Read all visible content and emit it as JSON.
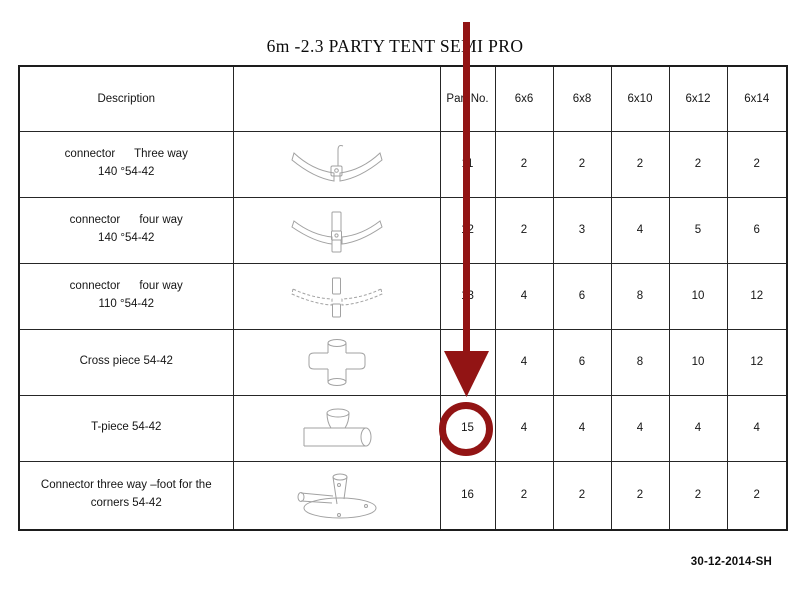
{
  "page": {
    "title": "6m -2.3 PARTY TENT SEMI PRO",
    "footer_code": "30-12-2014-SH"
  },
  "table": {
    "headers": [
      "Description",
      "",
      "Part No.",
      "6x6",
      "6x8",
      "6x10",
      "6x12",
      "6x14"
    ],
    "rows": [
      {
        "desc1": "connector      Three way",
        "desc2": "140 °54-42",
        "illustration": "three-way-connector-140-drawing",
        "part_no": "11",
        "qty": [
          "2",
          "2",
          "2",
          "2",
          "2"
        ]
      },
      {
        "desc1": "connector      four way",
        "desc2": "140 °54-42",
        "illustration": "four-way-connector-140-drawing",
        "part_no": "12",
        "qty": [
          "2",
          "3",
          "4",
          "5",
          "6"
        ]
      },
      {
        "desc1": "connector      four way",
        "desc2": "110 °54-42",
        "illustration": "four-way-connector-110-drawing",
        "part_no": "13",
        "qty": [
          "4",
          "6",
          "8",
          "10",
          "12"
        ]
      },
      {
        "desc1": "Cross piece 54-42",
        "desc2": "",
        "illustration": "cross-piece-drawing",
        "part_no": "14",
        "qty": [
          "4",
          "6",
          "8",
          "10",
          "12"
        ]
      },
      {
        "desc1": "T-piece 54-42",
        "desc2": "",
        "illustration": "t-piece-drawing",
        "part_no": "15",
        "qty": [
          "4",
          "4",
          "4",
          "4",
          "4"
        ]
      },
      {
        "desc1": "Connector three way –foot for the",
        "desc2": "corners 54-42",
        "illustration": "corner-foot-connector-drawing",
        "part_no": "16",
        "qty": [
          "2",
          "2",
          "2",
          "2",
          "2"
        ]
      }
    ]
  },
  "annotation": {
    "shape": "arrow-and-circle-highlight",
    "color": "#921414",
    "highlighted_part_no": "15"
  }
}
